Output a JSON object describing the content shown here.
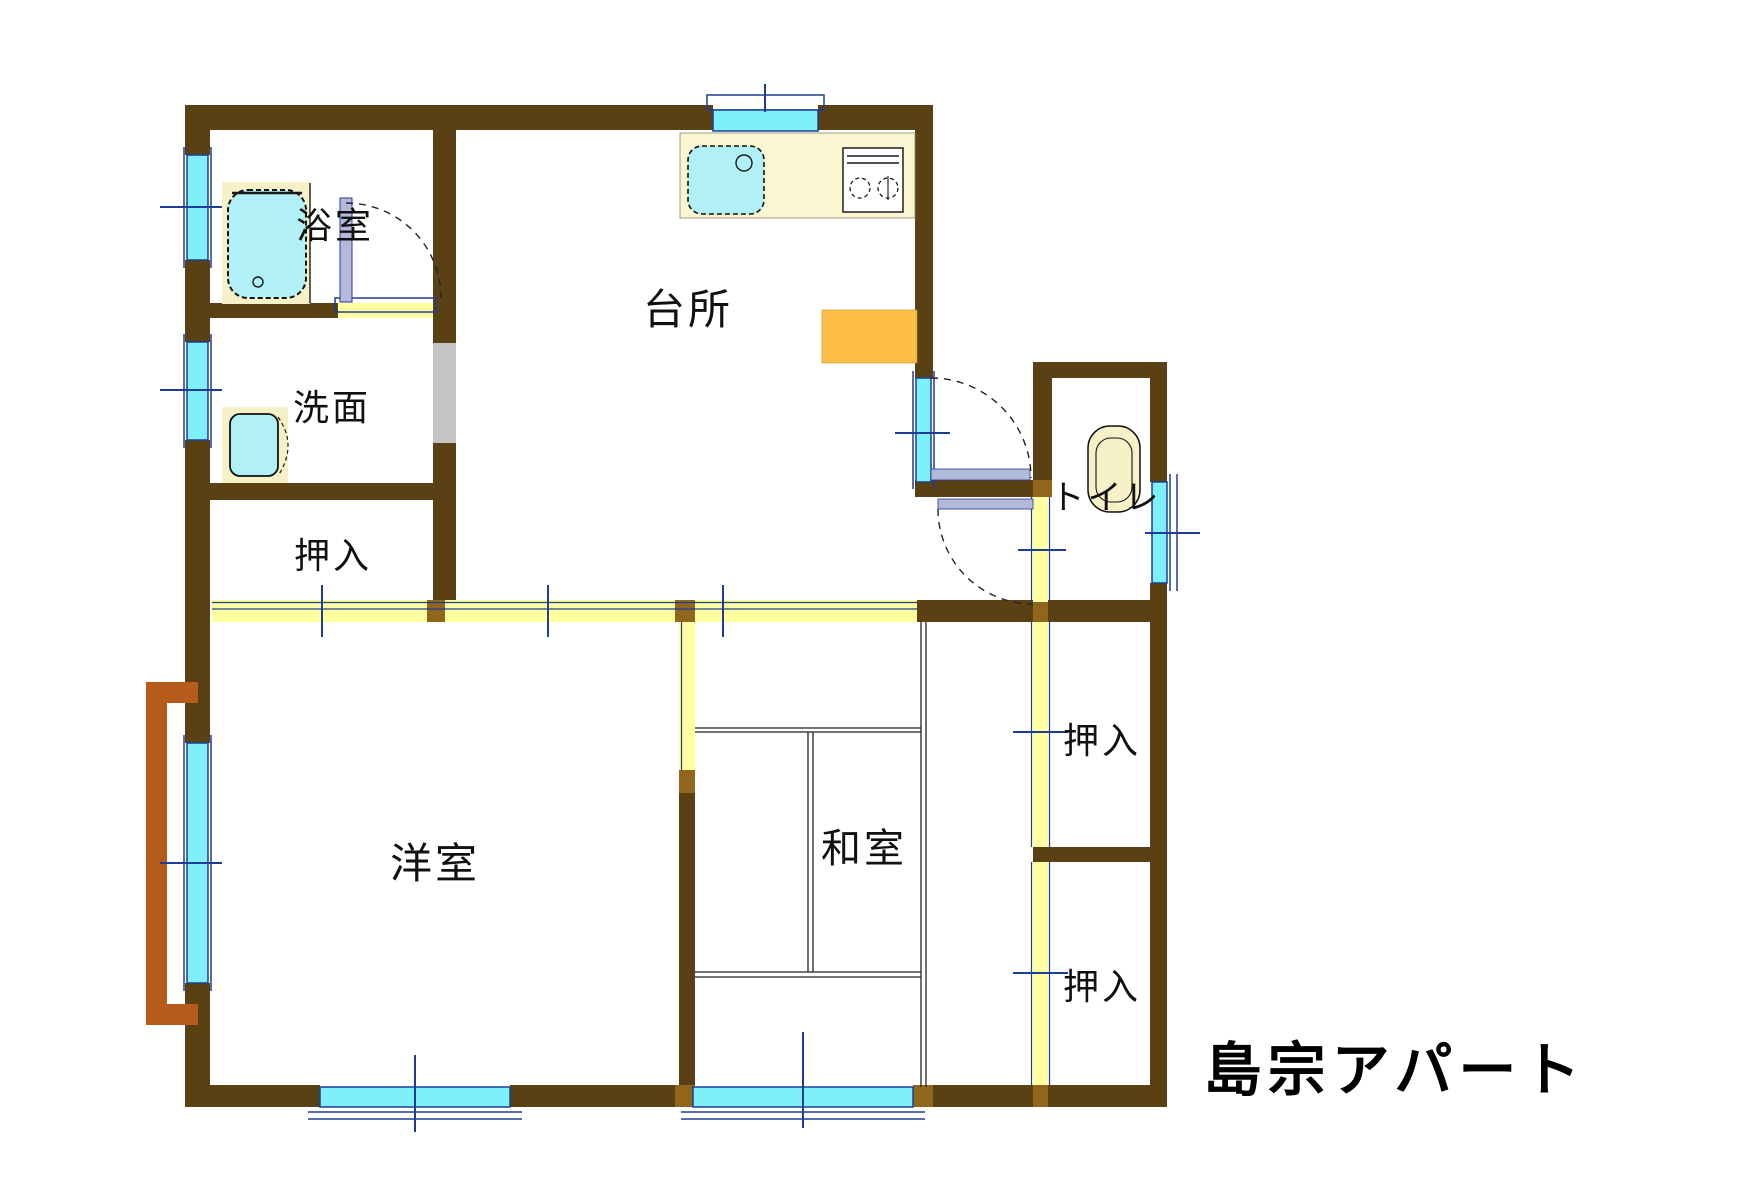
{
  "title": "島宗アパート",
  "rooms": {
    "bath": {
      "label": "浴室"
    },
    "washroom": {
      "label": "洗面"
    },
    "closet_top_left": {
      "label": "押入"
    },
    "kitchen": {
      "label": "台所"
    },
    "toilet": {
      "label": "トイレ"
    },
    "western_room": {
      "label": "洋室"
    },
    "japanese_room": {
      "label": "和室"
    },
    "closet_upper_right": {
      "label": "押入"
    },
    "closet_lower_right": {
      "label": "押入"
    }
  },
  "colors": {
    "wall": "#5a4113",
    "joint": "#90661c",
    "window": "#7df0fa",
    "frame": "#1e3d96",
    "fusuma": "#ffffa0",
    "counter": "#fbf6d2",
    "fixture": "#b0f0f6",
    "surround": "#f7f1c8",
    "appliance": "#fcbe46",
    "balcony": "#b55c1d",
    "sill": "#b3bad9",
    "graypanel": "#c4c4c4"
  }
}
